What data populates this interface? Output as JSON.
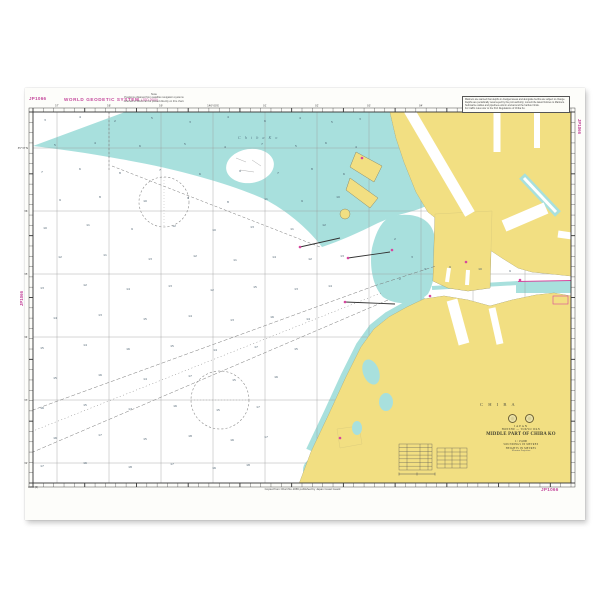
{
  "sheet": {
    "chart_number": "JP1066",
    "corner_number_topleft": "JP1066",
    "corner_number_bottomright": "JP1066",
    "side_number_left": "JP1066",
    "side_number_right": "JP1066",
    "wgs_label": "WORLD GEODETIC SYSTEM",
    "wgs_sub": "(JGD 2000)",
    "top_note_title": "Note",
    "top_note_line1": "Positions obtained from satellite navigation systems",
    "top_note_line2": "referred to WGS can be plotted directly on this chart.",
    "caution_line1": "Mariners are warned that depths in dredged areas and alongside berths are subject to change.",
    "caution_line2": "Depths are periodically resurveyed by the port authority; consult the latest Notices to Mariners.",
    "caution_line3": "Submarine cables and pipelines exist in and around the harbour limits.",
    "caution_line4": "For traffic rules refer to the Port Regulations of Chiba Ko.",
    "imprint": "Copied from Chart No.1066 published by Japan Coast Guard",
    "bottom_left_note": "1066 (6)"
  },
  "title_block": {
    "country": "JAPAN",
    "region": "HONSHU — TOKYO WAN",
    "title": "MIDDLE PART OF CHIBA KO",
    "scale": "1 : 15,000",
    "soundings_note": "SOUNDINGS IN METRES",
    "heights_note": "HEIGHTS IN METRES",
    "projection": "Mercator Projection"
  },
  "map_labels": {
    "sea": "C h i b a   K o",
    "city": "C H I B A"
  },
  "axis": {
    "top_longitudes": [
      "57′",
      "58′",
      "59′",
      "140°00′E",
      "01′",
      "02′",
      "03′",
      "04′",
      "05′",
      "06′"
    ],
    "left_latitudes": [
      "35°37′N",
      "36′",
      "35′",
      "34′",
      "33′",
      "32′"
    ]
  },
  "colors": {
    "land": "#f2df82",
    "shallow": "#a8e0dd",
    "magenta": "#c4479b",
    "ink": "#3a3a3a"
  },
  "soundings": [
    [
      45,
      121,
      "3"
    ],
    [
      80,
      118,
      "4"
    ],
    [
      115,
      122,
      "2"
    ],
    [
      152,
      119,
      "5"
    ],
    [
      190,
      123,
      "3"
    ],
    [
      228,
      118,
      "4"
    ],
    [
      265,
      122,
      "6"
    ],
    [
      300,
      119,
      "4"
    ],
    [
      332,
      123,
      "5"
    ],
    [
      360,
      120,
      "3"
    ],
    [
      55,
      146,
      "5"
    ],
    [
      95,
      144,
      "4"
    ],
    [
      140,
      147,
      "6"
    ],
    [
      185,
      145,
      "5"
    ],
    [
      225,
      148,
      "4"
    ],
    [
      262,
      145,
      "7"
    ],
    [
      296,
      147,
      "5"
    ],
    [
      326,
      144,
      "6"
    ],
    [
      356,
      148,
      "4"
    ],
    [
      42,
      173,
      "7"
    ],
    [
      80,
      170,
      "6"
    ],
    [
      120,
      174,
      "8"
    ],
    [
      160,
      171,
      "7"
    ],
    [
      200,
      175,
      "6"
    ],
    [
      240,
      172,
      "9"
    ],
    [
      278,
      174,
      "7"
    ],
    [
      312,
      170,
      "8"
    ],
    [
      344,
      175,
      "6"
    ],
    [
      60,
      201,
      "9"
    ],
    [
      100,
      198,
      "8"
    ],
    [
      145,
      202,
      "10"
    ],
    [
      188,
      199,
      "9"
    ],
    [
      228,
      203,
      "8"
    ],
    [
      266,
      200,
      "11"
    ],
    [
      302,
      202,
      "9"
    ],
    [
      338,
      198,
      "10"
    ],
    [
      45,
      229,
      "10"
    ],
    [
      88,
      226,
      "11"
    ],
    [
      132,
      230,
      "9"
    ],
    [
      174,
      227,
      "12"
    ],
    [
      214,
      231,
      "10"
    ],
    [
      252,
      228,
      "13"
    ],
    [
      292,
      230,
      "11"
    ],
    [
      324,
      226,
      "12"
    ],
    [
      60,
      258,
      "12"
    ],
    [
      105,
      256,
      "11"
    ],
    [
      150,
      260,
      "13"
    ],
    [
      195,
      257,
      "12"
    ],
    [
      235,
      261,
      "11"
    ],
    [
      274,
      258,
      "14"
    ],
    [
      310,
      260,
      "12"
    ],
    [
      342,
      257,
      "13"
    ],
    [
      42,
      289,
      "13"
    ],
    [
      85,
      286,
      "12"
    ],
    [
      128,
      290,
      "14"
    ],
    [
      170,
      287,
      "13"
    ],
    [
      212,
      291,
      "12"
    ],
    [
      255,
      288,
      "15"
    ],
    [
      296,
      290,
      "13"
    ],
    [
      330,
      287,
      "14"
    ],
    [
      55,
      319,
      "14"
    ],
    [
      100,
      316,
      "13"
    ],
    [
      145,
      320,
      "15"
    ],
    [
      190,
      317,
      "14"
    ],
    [
      232,
      321,
      "13"
    ],
    [
      272,
      318,
      "16"
    ],
    [
      308,
      320,
      "14"
    ],
    [
      42,
      349,
      "15"
    ],
    [
      85,
      346,
      "14"
    ],
    [
      128,
      350,
      "16"
    ],
    [
      172,
      347,
      "15"
    ],
    [
      215,
      351,
      "14"
    ],
    [
      256,
      348,
      "17"
    ],
    [
      296,
      350,
      "15"
    ],
    [
      55,
      379,
      "15"
    ],
    [
      100,
      376,
      "16"
    ],
    [
      145,
      380,
      "14"
    ],
    [
      190,
      377,
      "17"
    ],
    [
      234,
      381,
      "15"
    ],
    [
      276,
      378,
      "16"
    ],
    [
      42,
      409,
      "16"
    ],
    [
      85,
      406,
      "15"
    ],
    [
      130,
      410,
      "17"
    ],
    [
      175,
      407,
      "16"
    ],
    [
      218,
      411,
      "15"
    ],
    [
      258,
      408,
      "17"
    ],
    [
      55,
      439,
      "16"
    ],
    [
      100,
      436,
      "17"
    ],
    [
      145,
      440,
      "15"
    ],
    [
      190,
      437,
      "18"
    ],
    [
      232,
      441,
      "16"
    ],
    [
      266,
      438,
      "17"
    ],
    [
      42,
      467,
      "17"
    ],
    [
      85,
      464,
      "16"
    ],
    [
      130,
      468,
      "18"
    ],
    [
      172,
      465,
      "17"
    ],
    [
      214,
      469,
      "16"
    ],
    [
      248,
      466,
      "18"
    ],
    [
      395,
      240,
      "2"
    ],
    [
      412,
      258,
      "3"
    ],
    [
      400,
      280,
      "2"
    ],
    [
      425,
      270,
      "3"
    ],
    [
      450,
      268,
      "9"
    ],
    [
      480,
      270,
      "10"
    ],
    [
      510,
      272,
      "9"
    ]
  ]
}
